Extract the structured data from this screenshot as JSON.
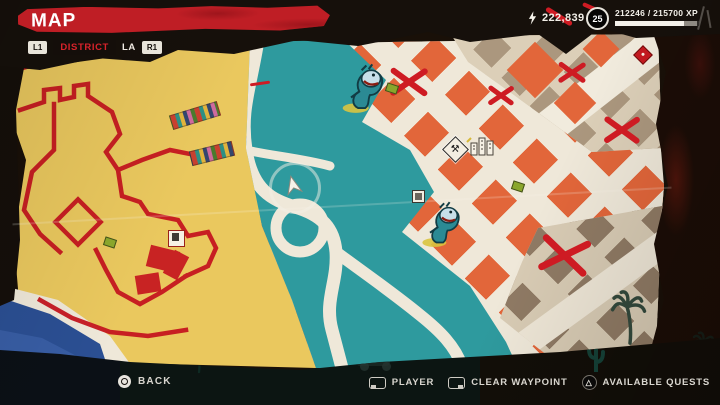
{
  "hud": {
    "title": "MAP",
    "district_selector": {
      "prev_button": "L1",
      "next_button": "R1",
      "tabs": [
        {
          "label": "DISTRICT",
          "selected": true
        },
        {
          "label": "LA",
          "selected": false
        }
      ]
    },
    "currency": {
      "icon": "lightning-icon",
      "amount": "222,839"
    },
    "level": {
      "badge": "25",
      "xp_text": "212246 / 215700 XP",
      "xp_fill_percent": 82,
      "xp_pending_percent": 16
    }
  },
  "bottom_bar": {
    "back": {
      "icon": "circle-button-icon",
      "label": "BACK"
    },
    "actions": [
      {
        "icon": "touchpad-swipe-left-icon",
        "label": "PLAYER"
      },
      {
        "icon": "touchpad-swipe-right-icon",
        "label": "CLEAR WAYPOINT"
      },
      {
        "icon": "triangle-button-icon",
        "label": "AVAILABLE QUESTS"
      }
    ]
  },
  "map": {
    "style": "hand-drawn district map",
    "colors": {
      "sand": "#eac85e",
      "park_teal": "#2e9a9e",
      "street": "#efe8d9",
      "building_orange": "#e2663a",
      "building_tan": "#ab977e",
      "building_brown": "#8f7a64",
      "ocean": "#2b4f93",
      "mark_red": "#ce1b23",
      "banner_red": "#bf1e25"
    },
    "markers": [
      {
        "name": "player-position-arrow",
        "count": 1
      },
      {
        "name": "zombie-threat-icon",
        "count": 2
      },
      {
        "name": "workbench-icon",
        "count": 1
      },
      {
        "name": "buildings-icon",
        "count": 1
      },
      {
        "name": "poi-square-icon",
        "count": 2
      },
      {
        "name": "red-diamond-poi-icon",
        "count": 1
      },
      {
        "name": "collectible-green-icon",
        "count": 3
      },
      {
        "name": "crossed-out-x-mark",
        "count": 5
      },
      {
        "name": "red-compound-wall-outline",
        "count": 1
      },
      {
        "name": "beach-towel-strip",
        "count": 2
      },
      {
        "name": "palm-tree-silhouette",
        "count": 3
      }
    ]
  }
}
